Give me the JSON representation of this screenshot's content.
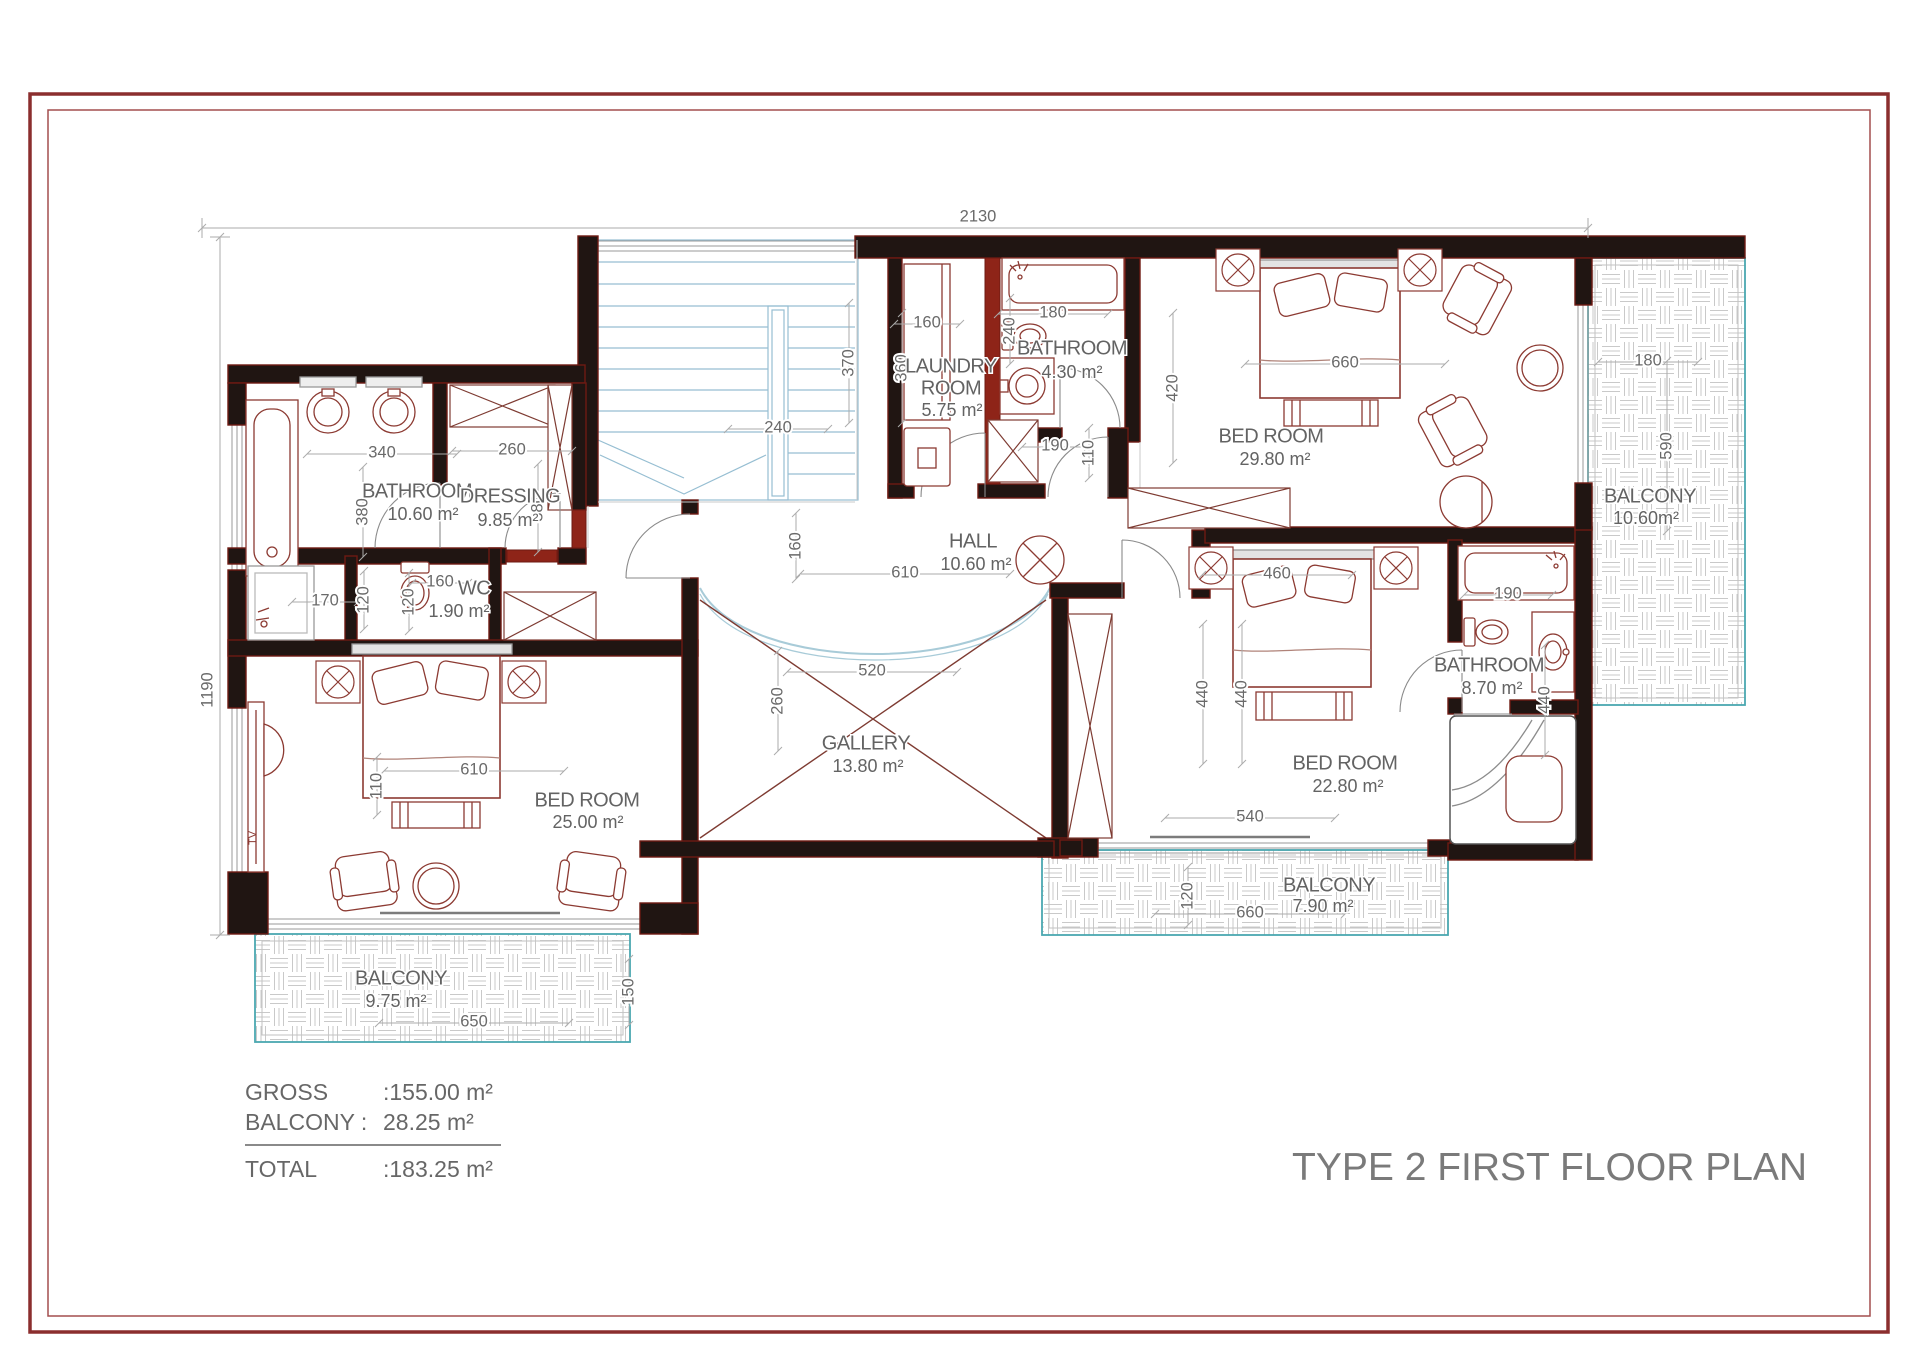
{
  "title": "TYPE 2 FIRST FLOOR PLAN",
  "summary": {
    "rows": [
      {
        "label": "GROSS",
        "value": ":155.00 m²"
      },
      {
        "label": "BALCONY :",
        "value": "28.25 m²"
      }
    ],
    "total": {
      "label": "TOTAL",
      "value": ":183.25 m²"
    }
  },
  "colors": {
    "wall_black": "#201512",
    "wall_red": "#8e2418",
    "furniture_red": "#8c3a32",
    "stair_blue": "#96bed2",
    "balcony_teal": "#4aa8b0",
    "dim_gray": "#6a6a6a",
    "frame_maroon": "#8b2e2e"
  },
  "rooms": [
    {
      "name": "BATHROOM",
      "area": "10.60 m²",
      "x": 417,
      "y": 492,
      "ax": 423,
      "ay": 515
    },
    {
      "name": "DRESSING",
      "area": "9.85 m²",
      "x": 510,
      "y": 497,
      "ax": 508,
      "ay": 521
    },
    {
      "name": "WC",
      "area": "1.90 m²",
      "x": 474,
      "y": 589,
      "ax": 459,
      "ay": 612
    },
    {
      "name": "LAUNDRY",
      "name2": "ROOM",
      "area": "5.75 m²",
      "x": 951,
      "y": 367,
      "x2": 951,
      "y2": 389,
      "ax": 952,
      "ay": 411
    },
    {
      "name": "BATHROOM",
      "area": "4.30 m²",
      "x": 1072,
      "y": 349,
      "ax": 1072,
      "ay": 373
    },
    {
      "name": "BED ROOM",
      "area": "29.80 m²",
      "x": 1271,
      "y": 437,
      "ax": 1275,
      "ay": 460
    },
    {
      "name": "BALCONY",
      "area": "10.60m²",
      "x": 1650,
      "y": 497,
      "ax": 1646,
      "ay": 519
    },
    {
      "name": "HALL",
      "area": "10.60 m²",
      "x": 973,
      "y": 542,
      "ax": 976,
      "ay": 565
    },
    {
      "name": "GALLERY",
      "area": "13.80 m²",
      "x": 866,
      "y": 744,
      "ax": 868,
      "ay": 767
    },
    {
      "name": "BED ROOM",
      "area": "25.00 m²",
      "x": 587,
      "y": 801,
      "ax": 588,
      "ay": 823
    },
    {
      "name": "BALCONY",
      "area": "9.75 m²",
      "x": 401,
      "y": 979,
      "ax": 396,
      "ay": 1002
    },
    {
      "name": "BED ROOM",
      "area": "22.80 m²",
      "x": 1345,
      "y": 764,
      "ax": 1348,
      "ay": 787
    },
    {
      "name": "BATHROOM",
      "area": "8.70 m²",
      "x": 1489,
      "y": 666,
      "ax": 1492,
      "ay": 689
    },
    {
      "name": "BALCONY",
      "area": "7.90 m²",
      "x": 1329,
      "y": 886,
      "ax": 1323,
      "ay": 907
    }
  ],
  "dims": [
    {
      "v": "2130",
      "x": 978,
      "y": 219,
      "o": "h",
      "x1": 202,
      "x2": 1588
    },
    {
      "v": "1190",
      "x": 208,
      "y": 690,
      "o": "v",
      "y1": 237,
      "y2": 935
    },
    {
      "v": "340",
      "x": 382,
      "y": 453,
      "o": "h",
      "len": 150
    },
    {
      "v": "380",
      "x": 363,
      "y": 512,
      "o": "v",
      "len": 90
    },
    {
      "v": "260",
      "x": 512,
      "y": 450,
      "o": "h",
      "len": 120
    },
    {
      "v": "380",
      "x": 538,
      "y": 508,
      "o": "v",
      "len": 88
    },
    {
      "v": "240",
      "x": 778,
      "y": 428,
      "o": "h",
      "len": 100
    },
    {
      "v": "370",
      "x": 849,
      "y": 363,
      "o": "v",
      "len": 120
    },
    {
      "v": "160",
      "x": 927,
      "y": 323,
      "o": "h",
      "len": 66
    },
    {
      "v": "360",
      "x": 902,
      "y": 368,
      "o": "v",
      "len": 110
    },
    {
      "v": "180",
      "x": 1053,
      "y": 313,
      "o": "h",
      "len": 110
    },
    {
      "v": "240",
      "x": 1010,
      "y": 331,
      "o": "v",
      "len": 66
    },
    {
      "v": "420",
      "x": 1173,
      "y": 388,
      "o": "v",
      "len": 150
    },
    {
      "v": "660",
      "x": 1345,
      "y": 363,
      "o": "h",
      "len": 200
    },
    {
      "v": "180",
      "x": 1648,
      "y": 361,
      "o": "h",
      "len": 100
    },
    {
      "v": "590",
      "x": 1667,
      "y": 446,
      "o": "v",
      "len": 170
    },
    {
      "v": "190",
      "x": 1055,
      "y": 446,
      "o": "h",
      "len": 66
    },
    {
      "v": "110",
      "x": 1089,
      "y": 453,
      "o": "v",
      "len": 50
    },
    {
      "v": "160",
      "x": 796,
      "y": 546,
      "o": "v",
      "len": 66
    },
    {
      "v": "610",
      "x": 905,
      "y": 573,
      "o": "h",
      "len": 210
    },
    {
      "v": "520",
      "x": 872,
      "y": 671,
      "o": "h",
      "len": 170
    },
    {
      "v": "260",
      "x": 778,
      "y": 701,
      "o": "v",
      "len": 100
    },
    {
      "v": "170",
      "x": 325,
      "y": 601,
      "o": "h",
      "len": 66
    },
    {
      "v": "120",
      "x": 364,
      "y": 600,
      "o": "v",
      "len": 58
    },
    {
      "v": "120",
      "x": 409,
      "y": 602,
      "o": "v",
      "len": 58
    },
    {
      "v": "160",
      "x": 440,
      "y": 582,
      "o": "h",
      "len": 56
    },
    {
      "v": "460",
      "x": 1277,
      "y": 574,
      "o": "h",
      "len": 150
    },
    {
      "v": "440",
      "x": 1203,
      "y": 694,
      "o": "v",
      "len": 140
    },
    {
      "v": "440",
      "x": 1242,
      "y": 694,
      "o": "v",
      "len": 140
    },
    {
      "v": "190",
      "x": 1508,
      "y": 594,
      "o": "h",
      "len": 88
    },
    {
      "v": "440",
      "x": 1545,
      "y": 700,
      "o": "v",
      "len": 110
    },
    {
      "v": "610",
      "x": 474,
      "y": 770,
      "o": "h",
      "len": 180
    },
    {
      "v": "110",
      "x": 377,
      "y": 786,
      "o": "v",
      "len": 58
    },
    {
      "v": "540",
      "x": 1250,
      "y": 817,
      "o": "h",
      "len": 170
    },
    {
      "v": "650",
      "x": 474,
      "y": 1022,
      "o": "h",
      "len": 190
    },
    {
      "v": "150",
      "x": 629,
      "y": 992,
      "o": "v",
      "len": 66
    },
    {
      "v": "660",
      "x": 1250,
      "y": 913,
      "o": "h",
      "len": 190
    },
    {
      "v": "120",
      "x": 1188,
      "y": 896,
      "o": "v",
      "len": 58
    }
  ],
  "labels": {
    "tv": "TV"
  }
}
